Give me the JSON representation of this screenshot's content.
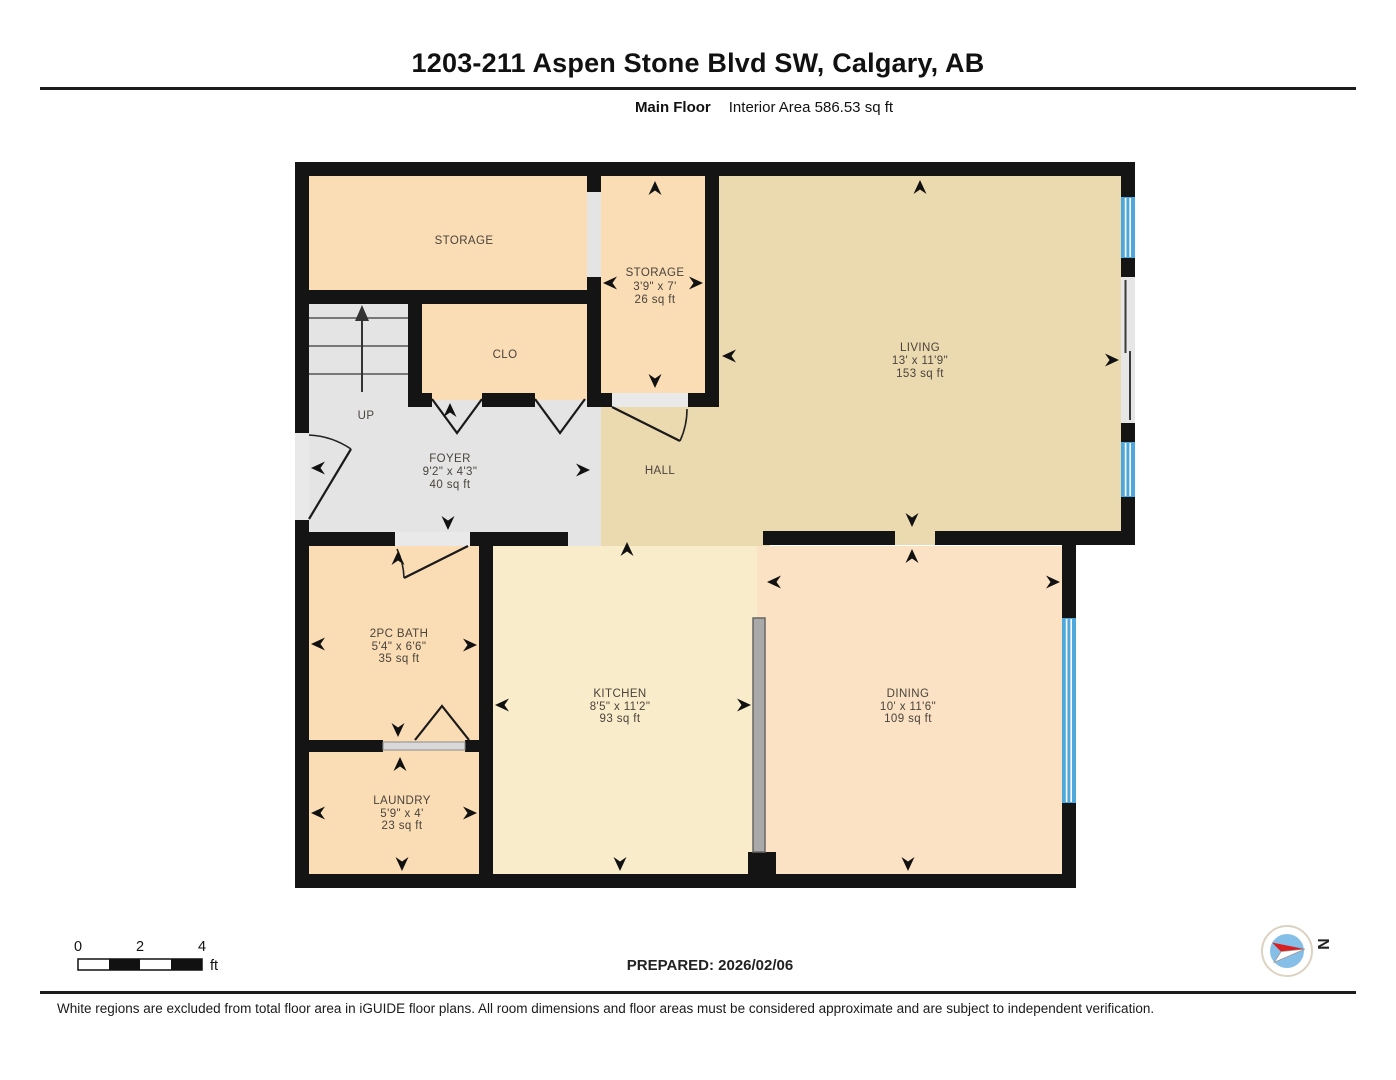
{
  "header": {
    "title": "1203-211 Aspen Stone Blvd SW, Calgary, AB",
    "floor_label": "Main Floor",
    "interior_area": "Interior Area 586.53 sq ft"
  },
  "rooms": {
    "storage1": {
      "name": "STORAGE"
    },
    "storage2": {
      "name": "STORAGE",
      "dims": "3'9\" x 7'",
      "area": "26 sq ft"
    },
    "closet": {
      "name": "CLO"
    },
    "stairs": {
      "name": "UP"
    },
    "living": {
      "name": "LIVING",
      "dims": "13' x 11'9\"",
      "area": "153 sq ft"
    },
    "foyer": {
      "name": "FOYER",
      "dims": "9'2\" x 4'3\"",
      "area": "40 sq ft"
    },
    "hall": {
      "name": "HALL"
    },
    "bath": {
      "name": "2PC BATH",
      "dims": "5'4\" x 6'6\"",
      "area": "35 sq ft"
    },
    "laundry": {
      "name": "LAUNDRY",
      "dims": "5'9\" x 4'",
      "area": "23 sq ft"
    },
    "kitchen": {
      "name": "KITCHEN",
      "dims": "8'5\" x 11'2\"",
      "area": "93 sq ft"
    },
    "dining": {
      "name": "DINING",
      "dims": "10' x 11'6\"",
      "area": "109 sq ft"
    }
  },
  "scale_bar": {
    "tick0": "0",
    "tick1": "2",
    "tick2": "4",
    "unit": "ft"
  },
  "compass": {
    "north": "N"
  },
  "footer": {
    "prepared": "PREPARED: 2026/02/06",
    "disclaimer": "White regions are excluded from total floor area in iGUIDE floor plans. All room dimensions and floor areas must be considered approximate and are subject to independent verification."
  },
  "colors": {
    "wall": "#141414",
    "room_peach": "#fadcb5",
    "room_peach_light": "#fbe2c4",
    "room_tan": "#ebd9b0",
    "room_cream": "#f9ecca",
    "floor_gray": "#e4e4e4",
    "opening_gray": "#e9e9e9",
    "window_blue": "#4fa8dc",
    "partition_gray": "#a9a9a9"
  }
}
